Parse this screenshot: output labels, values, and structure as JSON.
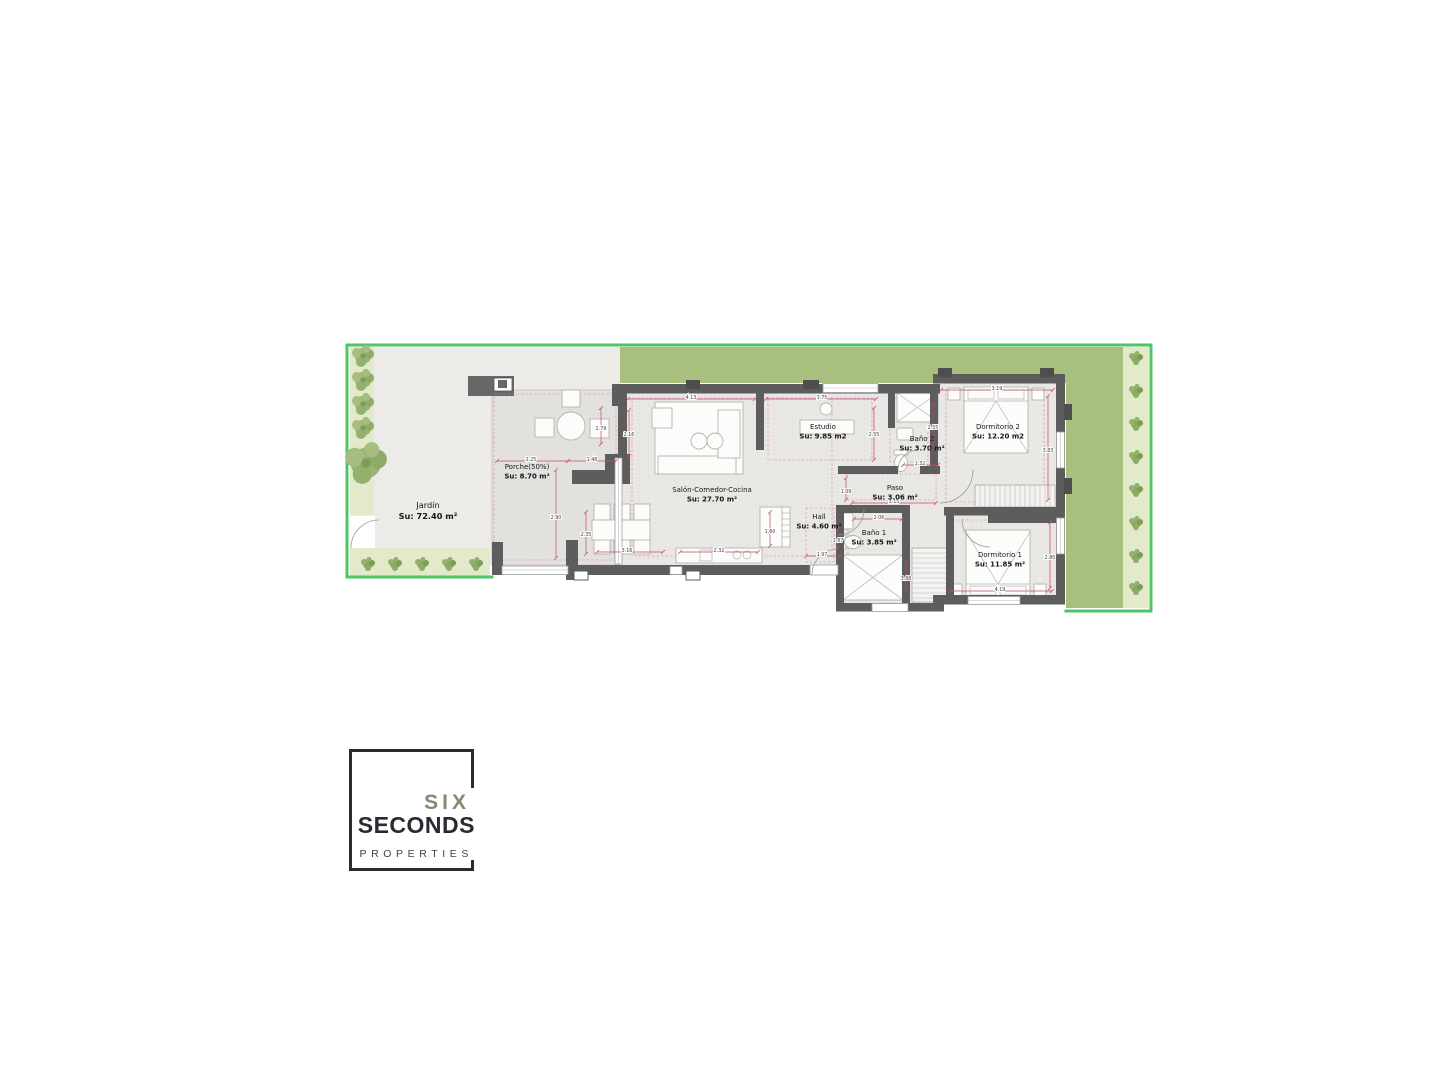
{
  "document": {
    "background": "#ffffff",
    "type": "floor-plan-sheet"
  },
  "plan": {
    "region": {
      "x": 345,
      "y": 342,
      "width": 810,
      "height": 272
    },
    "colors": {
      "frame": "#4fc564",
      "grass": "#a8bf7d",
      "strip": "#e2eaca",
      "paving": "#edebe7",
      "porch": "#e3e1dd",
      "floor": "#e9e8e4",
      "wall": "#5d5d5d",
      "dim": "#c2486b",
      "accent": "#e0849c",
      "furniture_stroke": "#b5b3ae"
    },
    "rooms": [
      {
        "id": "jardin",
        "name": "Jardín",
        "area": "Su: 72.40 m²",
        "label_x": 428,
        "label_y": 508,
        "big": true
      },
      {
        "id": "porche",
        "name": "Porche(50%)",
        "area": "Su: 8.70 m²",
        "label_x": 527,
        "label_y": 469,
        "big": false
      },
      {
        "id": "salon",
        "name": "Salón-Comedor-Cocina",
        "area": "Su: 27.70 m²",
        "label_x": 712,
        "label_y": 492,
        "big": false
      },
      {
        "id": "estudio",
        "name": "Estudio",
        "area": "Su: 9.85 m2",
        "label_x": 823,
        "label_y": 429,
        "big": false
      },
      {
        "id": "bano2",
        "name": "Baño 2",
        "area": "Su: 3.70 m²",
        "label_x": 922,
        "label_y": 441,
        "big": false
      },
      {
        "id": "dorm2",
        "name": "Dormitorio 2",
        "area": "Su: 12.20 m2",
        "label_x": 998,
        "label_y": 429,
        "big": false
      },
      {
        "id": "paso",
        "name": "Paso",
        "area": "Su: 3.06 m²",
        "label_x": 895,
        "label_y": 490,
        "big": false
      },
      {
        "id": "hall",
        "name": "Hall",
        "area": "Su: 4.60 m²",
        "label_x": 819,
        "label_y": 519,
        "big": false
      },
      {
        "id": "bano1",
        "name": "Baño 1",
        "area": "Su: 3.85 m²",
        "label_x": 874,
        "label_y": 535,
        "big": false
      },
      {
        "id": "dorm1",
        "name": "Dormitorio 1",
        "area": "Su: 11.85 m²",
        "label_x": 1000,
        "label_y": 557,
        "big": false
      }
    ],
    "dimensions": [
      {
        "x1": 628,
        "y1": 399,
        "x2": 755,
        "y2": 399,
        "label": "4.13",
        "lx": 691,
        "ly": 397
      },
      {
        "x1": 766,
        "y1": 399,
        "x2": 876,
        "y2": 399,
        "label": "3.75",
        "lx": 822,
        "ly": 397
      },
      {
        "x1": 874,
        "y1": 408,
        "x2": 874,
        "y2": 460,
        "label": "2.55",
        "lx": 874,
        "ly": 434
      },
      {
        "x1": 933,
        "y1": 404,
        "x2": 933,
        "y2": 448,
        "label": "2.55",
        "lx": 933,
        "ly": 427
      },
      {
        "x1": 941,
        "y1": 390,
        "x2": 1053,
        "y2": 390,
        "label": "3.19",
        "lx": 997,
        "ly": 388
      },
      {
        "x1": 1048,
        "y1": 396,
        "x2": 1048,
        "y2": 500,
        "label": "3.83",
        "lx": 1048,
        "ly": 450
      },
      {
        "x1": 903,
        "y1": 465,
        "x2": 938,
        "y2": 465,
        "label": "1.32",
        "lx": 920,
        "ly": 463
      },
      {
        "x1": 497,
        "y1": 461,
        "x2": 568,
        "y2": 461,
        "label": "2.25",
        "lx": 531,
        "ly": 459
      },
      {
        "x1": 568,
        "y1": 461,
        "x2": 616,
        "y2": 461,
        "label": "1.48",
        "lx": 592,
        "ly": 459
      },
      {
        "x1": 601,
        "y1": 408,
        "x2": 601,
        "y2": 444,
        "label": "2.79",
        "lx": 601,
        "ly": 428
      },
      {
        "x1": 629,
        "y1": 410,
        "x2": 629,
        "y2": 456,
        "label": "2.16",
        "lx": 629,
        "ly": 434
      },
      {
        "x1": 556,
        "y1": 470,
        "x2": 556,
        "y2": 558,
        "label": "2.90",
        "lx": 556,
        "ly": 517
      },
      {
        "x1": 586,
        "y1": 512,
        "x2": 586,
        "y2": 554,
        "label": "2.35",
        "lx": 586,
        "ly": 534
      },
      {
        "x1": 597,
        "y1": 552,
        "x2": 663,
        "y2": 552,
        "label": "3.16",
        "lx": 627,
        "ly": 550
      },
      {
        "x1": 680,
        "y1": 552,
        "x2": 758,
        "y2": 552,
        "label": "2.32",
        "lx": 719,
        "ly": 550
      },
      {
        "x1": 770,
        "y1": 512,
        "x2": 770,
        "y2": 546,
        "label": "1.60",
        "lx": 770,
        "ly": 531
      },
      {
        "x1": 806,
        "y1": 556,
        "x2": 840,
        "y2": 556,
        "label": "1.97",
        "lx": 822,
        "ly": 554
      },
      {
        "x1": 846,
        "y1": 478,
        "x2": 846,
        "y2": 500,
        "label": "1.09",
        "lx": 846,
        "ly": 491
      },
      {
        "x1": 852,
        "y1": 503,
        "x2": 936,
        "y2": 503,
        "label": "3.15",
        "lx": 894,
        "ly": 501
      },
      {
        "x1": 854,
        "y1": 519,
        "x2": 902,
        "y2": 519,
        "label": "2.06",
        "lx": 879,
        "ly": 517
      },
      {
        "x1": 838,
        "y1": 528,
        "x2": 838,
        "y2": 548,
        "label": "1.87",
        "lx": 838,
        "ly": 540
      },
      {
        "x1": 906,
        "y1": 562,
        "x2": 906,
        "y2": 590,
        "label": "1.88",
        "lx": 906,
        "ly": 578
      },
      {
        "x1": 950,
        "y1": 591,
        "x2": 1052,
        "y2": 591,
        "label": "4.19",
        "lx": 1000,
        "ly": 589
      },
      {
        "x1": 1050,
        "y1": 522,
        "x2": 1050,
        "y2": 588,
        "label": "2.80",
        "lx": 1050,
        "ly": 557
      }
    ],
    "garden": {
      "left_trees": [
        [
          363,
          356
        ],
        [
          363,
          380
        ],
        [
          363,
          404
        ],
        [
          363,
          428
        ]
      ],
      "big_tree": [
        366,
        463,
        1.9
      ],
      "bottom_bushes": {
        "y": 564,
        "x": [
          368,
          395,
          422,
          449,
          476
        ]
      },
      "right_bushes": {
        "x": 1136,
        "y": [
          358,
          391,
          424,
          457,
          490,
          523,
          556,
          588
        ]
      }
    },
    "stairs": [
      {
        "x": 975,
        "y": 485,
        "w": 80,
        "h": 22,
        "dir": "v",
        "step": 5
      },
      {
        "x": 912,
        "y": 548,
        "w": 36,
        "h": 54,
        "dir": "h",
        "step": 5
      }
    ]
  },
  "logo": {
    "top": "SIX",
    "middle": "SECONDS",
    "bottom": "PROPERTIES",
    "dark_color": "#2b2a30",
    "gray_color": "#8b8574"
  }
}
